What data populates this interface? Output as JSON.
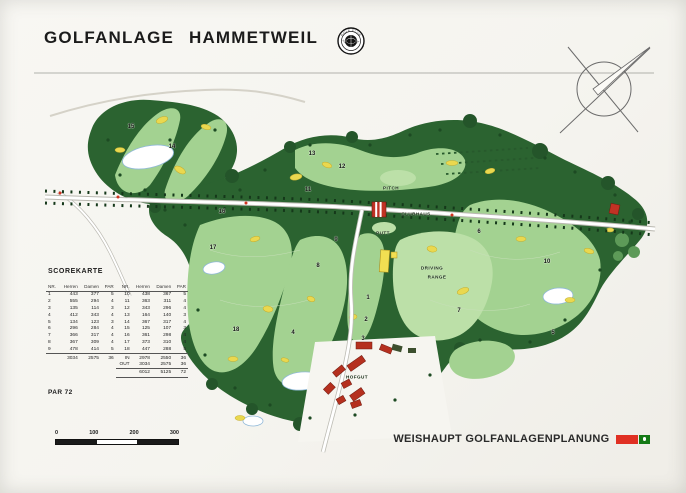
{
  "header": {
    "title": "GOLFANLAGE HAMMETWEIL",
    "logo": {
      "top_text": "GOLF CLUB",
      "bottom_text": "HAMMETWEIL"
    }
  },
  "scorecard": {
    "heading": "SCOREKARTE",
    "columns": [
      "NR.",
      "Herren",
      "Damen",
      "PAR",
      "NR.",
      "Herren",
      "Damen",
      "PAR"
    ],
    "rows": [
      [
        "1",
        "443",
        "377",
        "5",
        "10",
        "438",
        "367",
        "5"
      ],
      [
        "2",
        "555",
        "294",
        "4",
        "11",
        "363",
        "311",
        "4"
      ],
      [
        "3",
        "135",
        "114",
        "3",
        "12",
        "343",
        "296",
        "4"
      ],
      [
        "4",
        "412",
        "343",
        "4",
        "13",
        "164",
        "140",
        "3"
      ],
      [
        "5",
        "134",
        "123",
        "3",
        "14",
        "367",
        "317",
        "4"
      ],
      [
        "6",
        "296",
        "284",
        "4",
        "15",
        "125",
        "107",
        "3"
      ],
      [
        "7",
        "366",
        "317",
        "4",
        "16",
        "361",
        "298",
        "4"
      ],
      [
        "8",
        "367",
        "309",
        "4",
        "17",
        "373",
        "310",
        "4"
      ],
      [
        "9",
        "478",
        "414",
        "5",
        "18",
        "447",
        "288",
        "5"
      ]
    ],
    "totals": [
      [
        "",
        "3034",
        "2575",
        "36",
        "IN",
        "2978",
        "2550",
        "36"
      ],
      [
        "",
        "",
        "",
        "",
        "OUT",
        "3034",
        "2575",
        "36"
      ],
      [
        "",
        "",
        "",
        "",
        "",
        "6012",
        "5125",
        "72"
      ]
    ],
    "par_label": "PAR 72"
  },
  "map": {
    "labels": [
      {
        "text": "PITCH",
        "x": 391,
        "y": 188
      },
      {
        "text": "CLUBHAUS",
        "x": 416,
        "y": 214
      },
      {
        "text": "PUTT",
        "x": 383,
        "y": 233
      },
      {
        "text": "DRIVING",
        "x": 432,
        "y": 268
      },
      {
        "text": "RANGE",
        "x": 437,
        "y": 277
      },
      {
        "text": "HOFGUT",
        "x": 357,
        "y": 377
      }
    ],
    "holes": [
      {
        "n": "1",
        "x": 368,
        "y": 298
      },
      {
        "n": "2",
        "x": 366,
        "y": 320
      },
      {
        "n": "3",
        "x": 363,
        "y": 339
      },
      {
        "n": "4",
        "x": 293,
        "y": 333
      },
      {
        "n": "5",
        "x": 553,
        "y": 333
      },
      {
        "n": "6",
        "x": 479,
        "y": 232
      },
      {
        "n": "7",
        "x": 459,
        "y": 311
      },
      {
        "n": "8",
        "x": 318,
        "y": 266
      },
      {
        "n": "9",
        "x": 336,
        "y": 240
      },
      {
        "n": "10",
        "x": 547,
        "y": 262
      },
      {
        "n": "11",
        "x": 308,
        "y": 190
      },
      {
        "n": "12",
        "x": 342,
        "y": 167
      },
      {
        "n": "13",
        "x": 312,
        "y": 154
      },
      {
        "n": "14",
        "x": 172,
        "y": 147
      },
      {
        "n": "15",
        "x": 131,
        "y": 127
      },
      {
        "n": "16",
        "x": 222,
        "y": 212
      },
      {
        "n": "17",
        "x": 213,
        "y": 248
      },
      {
        "n": "18",
        "x": 236,
        "y": 330
      }
    ]
  },
  "scalebar": {
    "labels": [
      "0",
      "100",
      "200",
      "300"
    ]
  },
  "footer": {
    "credit": "WEISHAUPT GOLFANLAGENPLANUNG"
  },
  "colors": {
    "forest": "#2b6330",
    "fairway": "#a3d291",
    "bunker": "#ead84f",
    "building_red": "#c03224",
    "credit_red": "#e03023",
    "credit_green": "#157a15"
  }
}
